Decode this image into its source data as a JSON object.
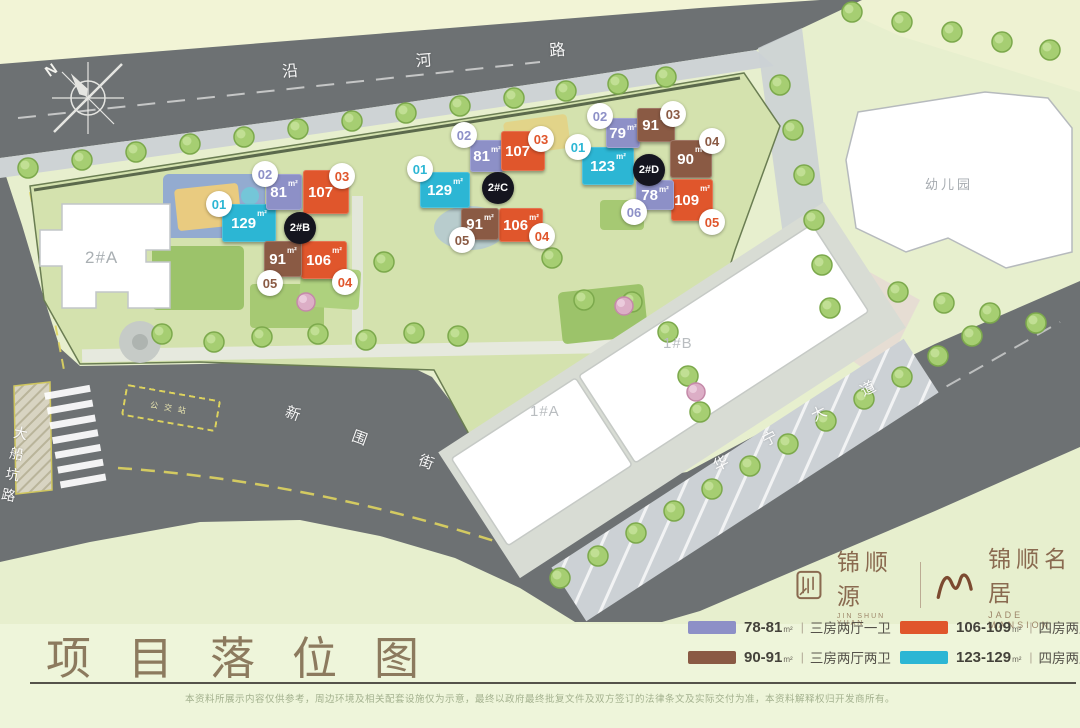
{
  "poster": {
    "title": "项目落位图",
    "legend_divider": "|",
    "legend": [
      {
        "range": "78-81",
        "area_unit": "m²",
        "type": "三房两厅一卫",
        "color": "#8d90c7"
      },
      {
        "range": "106-109",
        "area_unit": "m²",
        "type": "四房两厅两卫",
        "color": "#e0562c"
      },
      {
        "range": "90-91",
        "area_unit": "m²",
        "type": "三房两厅两卫",
        "color": "#8a5a44"
      },
      {
        "range": "123-129",
        "area_unit": "m²",
        "type": "四房两厅两卫",
        "color": "#2cb6d4"
      }
    ],
    "brand": {
      "logo_left": {
        "name_cn": "锦顺源",
        "name_en": "JIN SHUN YUAN"
      },
      "logo_right": {
        "name_cn": "锦顺名居",
        "name_en": "JADE MANSION"
      }
    },
    "disclaimer": "本资料所展示内容仅供参考，周边环境及相关配套设施仅为示意，最终以政府最终批复文件及双方签订的法律条文及实际交付为准，本资料解释权归开发商所有。"
  },
  "map": {
    "compass": "N",
    "area_unit": "m²",
    "roads": {
      "north": "沿河路",
      "west": "大船坑路",
      "south": "新围街",
      "east": "华宁大道"
    },
    "bus_stop": "公交站",
    "buildings": {
      "b2a": "2#A",
      "b1a": "1#A",
      "b1b": "1#B",
      "kindergarten": "幼儿园"
    },
    "towers": [
      {
        "id": "2#B",
        "units": [
          {
            "no": "01",
            "area": "129",
            "color": "#2cb6d4"
          },
          {
            "no": "02",
            "area": "81",
            "color": "#8d90c7"
          },
          {
            "no": "03",
            "area": "107",
            "color": "#e0562c"
          },
          {
            "no": "04",
            "area": "106",
            "color": "#e0562c"
          },
          {
            "no": "05",
            "area": "91",
            "color": "#8a5a44"
          }
        ]
      },
      {
        "id": "2#C",
        "units": [
          {
            "no": "01",
            "area": "129",
            "color": "#2cb6d4"
          },
          {
            "no": "02",
            "area": "81",
            "color": "#8d90c7"
          },
          {
            "no": "03",
            "area": "107",
            "color": "#e0562c"
          },
          {
            "no": "04",
            "area": "106",
            "color": "#e0562c"
          },
          {
            "no": "05",
            "area": "91",
            "color": "#8a5a44"
          }
        ]
      },
      {
        "id": "2#D",
        "units": [
          {
            "no": "01",
            "area": "123",
            "color": "#2cb6d4"
          },
          {
            "no": "02",
            "area": "79",
            "color": "#8d90c7"
          },
          {
            "no": "03",
            "area": "91",
            "color": "#8a5a44"
          },
          {
            "no": "04",
            "area": "90",
            "color": "#8a5a44"
          },
          {
            "no": "05",
            "area": "109",
            "color": "#e0562c"
          },
          {
            "no": "06",
            "area": "78",
            "color": "#8d90c7"
          }
        ]
      }
    ]
  }
}
